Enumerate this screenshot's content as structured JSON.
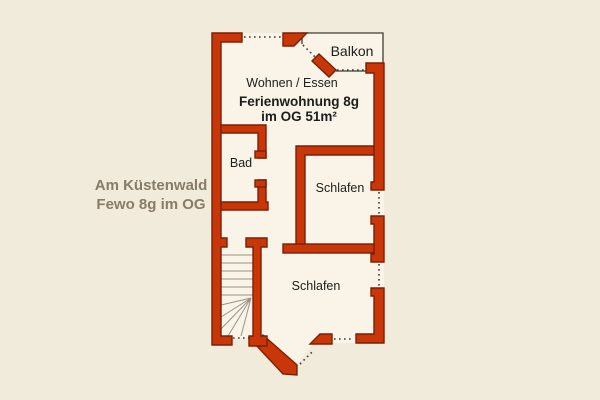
{
  "plan": {
    "title_line1": "Ferienwohnung 8g",
    "title_line2": "im OG   51m²",
    "side_label_line1": "Am Küstenwald",
    "side_label_line2": "Fewo 8g im OG",
    "rooms": {
      "balcony": "Balkon",
      "living": "Wohnen / Essen",
      "bath": "Bad",
      "bedroom1": "Schlafen",
      "bedroom2": "Schlafen"
    },
    "colors": {
      "wall_fill": "#c93708",
      "wall_outline": "#7a2004",
      "floor": "#f9f4e7",
      "background": "#f1ebdb",
      "balcony_outline": "#3c3c34",
      "stair_lines": "#9a938a",
      "opening_dots": "#3a3a3a",
      "text": "#1d1d1b",
      "side_label_text": "#877c68"
    }
  }
}
